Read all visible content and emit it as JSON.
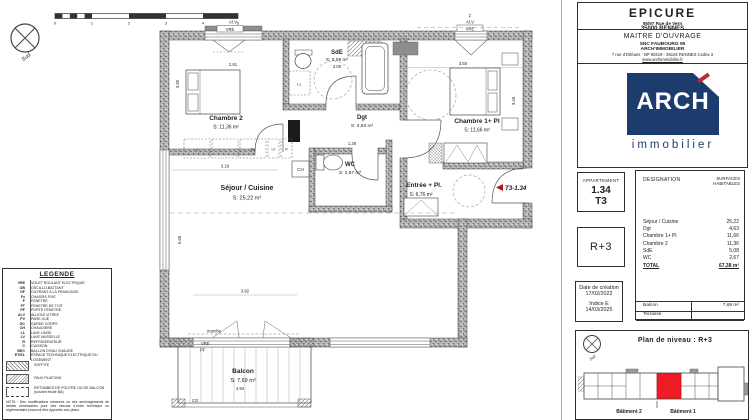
{
  "scalebar": {
    "ticks": [
      "0",
      "1",
      "2",
      "3",
      "4",
      "5"
    ]
  },
  "plan": {
    "rooms": [
      {
        "name": "Chambre 2",
        "area": "S: 11,36 m²"
      },
      {
        "name": "SdE",
        "area": "S: 5,08 m²"
      },
      {
        "name": "Dgt",
        "area": "S: 4,63 m²"
      },
      {
        "name": "WC",
        "area": "S: 2,67 m²"
      },
      {
        "name": "Chambre 1+ Pl",
        "area": "S: 11,66 m²"
      },
      {
        "name": "Entrée + Pl.",
        "area": "S: 6,76 m²"
      },
      {
        "name": "Séjour / Cuisine",
        "area": "S: 25,22 m²"
      },
      {
        "name": "Balcon",
        "area": "S: 7,69 m²"
      }
    ],
    "dims": {
      "c2_w": "2.91",
      "c2_d": "3.90",
      "sde_w": "3.00",
      "wc_w": "1.26",
      "c1_w": "3.50",
      "c1_d": "3.46",
      "sej_w": "3.19",
      "sej_d": "6.68",
      "sej_b": "3.82",
      "balcon_w": "4.94"
    },
    "tags": {
      "sud": "Sud",
      "alv": "Al.V",
      "vre": "VRE",
      "f": "F",
      "pf": "PF",
      "cg": "CG",
      "ch": "CH",
      "ll": "LL",
      "marche": "marche",
      "cuisson": "c",
      "evier": "Ev",
      "lave_vaisselle": "LV",
      "refrigerateur": "R",
      "unit_ref": "T3-1.34"
    }
  },
  "title_block": {
    "project": "EPICURE",
    "address_line1": "95/97  Rue de Vern",
    "address_line2": "35000  RENNES",
    "owner_heading": "MAITRE D'OUVRAGE",
    "owner_line1": "SNC FAUBOURG 95",
    "owner_line2": "ARCH'IMMOBILIER",
    "owner_line3": "7 rue d'Orléans - BP 90419 - 35104  RENNES Cedex 3",
    "owner_line4": "www.archimmobilier.fr",
    "logo_text": "ARCH",
    "logo_sub": "immobilier"
  },
  "apartment_card": {
    "heading": "APPARTEMENT",
    "number": "1.34",
    "type": "T3"
  },
  "level_card": {
    "label": "R+3"
  },
  "date_card": {
    "line1": "Date de création",
    "line2": "17/02/2022",
    "line3": "Indice E",
    "line4": "14/03/2025"
  },
  "surface_table": {
    "col1": "DESIGNATION",
    "col2": "SURFACES HABITABLES",
    "rows": [
      {
        "label": "Séjour / Cuisine",
        "value": "25,22"
      },
      {
        "label": "Dgt",
        "value": "4,63"
      },
      {
        "label": "Chambre 1+ Pl",
        "value": "11,66"
      },
      {
        "label": "Chambre 2",
        "value": "11,36"
      },
      {
        "label": "SdE",
        "value": "5,08"
      },
      {
        "label": "WC",
        "value": "2,67"
      }
    ],
    "total_label": "TOTAL",
    "total_value": "67,38 m²",
    "annex_rows": [
      {
        "label": "Balcon",
        "value": "7,69 m²"
      },
      {
        "label": "Terrasse",
        "value": ""
      }
    ]
  },
  "level_plan": {
    "title": "Plan de niveau : R+3",
    "building1": "Bâtiment 2",
    "building2": "Bâtiment 1",
    "sud": "Sud"
  },
  "legend": {
    "title": "LEGENDE",
    "items": [
      {
        "abbr": "VRE",
        "label": "VOLET ROULANT ELECTRIQUE"
      },
      {
        "abbr": "OB",
        "label": "OSCILLO-BATTANT"
      },
      {
        "abbr": "OF",
        "label": "OUVRANT A LA FRANCAISE"
      },
      {
        "abbr": "Fx",
        "label": "CHASSIS FIXE"
      },
      {
        "abbr": "F",
        "label": "FENETRE"
      },
      {
        "abbr": "FT",
        "label": "FENETRE DE TOIT"
      },
      {
        "abbr": "PF",
        "label": "PORTE FENETRE"
      },
      {
        "abbr": "Al.V",
        "label": "ALLEGE VITREE"
      },
      {
        "abbr": "PV",
        "label": "PARE-VUE"
      },
      {
        "abbr": "GC",
        "label": "GARDE CORPS"
      },
      {
        "abbr": "CH",
        "label": "CHAUDIERE"
      },
      {
        "abbr": "LL",
        "label": "LAVE LINGE"
      },
      {
        "abbr": "LV",
        "label": "LAVE VAISSELLE"
      },
      {
        "abbr": "R",
        "label": "REFRIGERATEUR"
      },
      {
        "abbr": "C",
        "label": "CUISSON"
      },
      {
        "abbr": "BEC",
        "label": "BALLON D'EAU CHAUDE"
      },
      {
        "abbr": "ET/EL",
        "label": "ESPACE TECHNIQUE ELECTRIQUE DU LOGEMENT"
      }
    ],
    "swatches": [
      {
        "label": "SOFFITE"
      },
      {
        "label": "FAUX PLAFOND"
      },
      {
        "label": "RETOMBES DE POUTRE OU DE BALCON (suivant étude BA)"
      }
    ],
    "nota": "NOTA : Des modifications mineures ou des aménagements de détails nécessaires pour des raisons d'ordre technique ou réglementaire pourront être apportés aux plans."
  }
}
